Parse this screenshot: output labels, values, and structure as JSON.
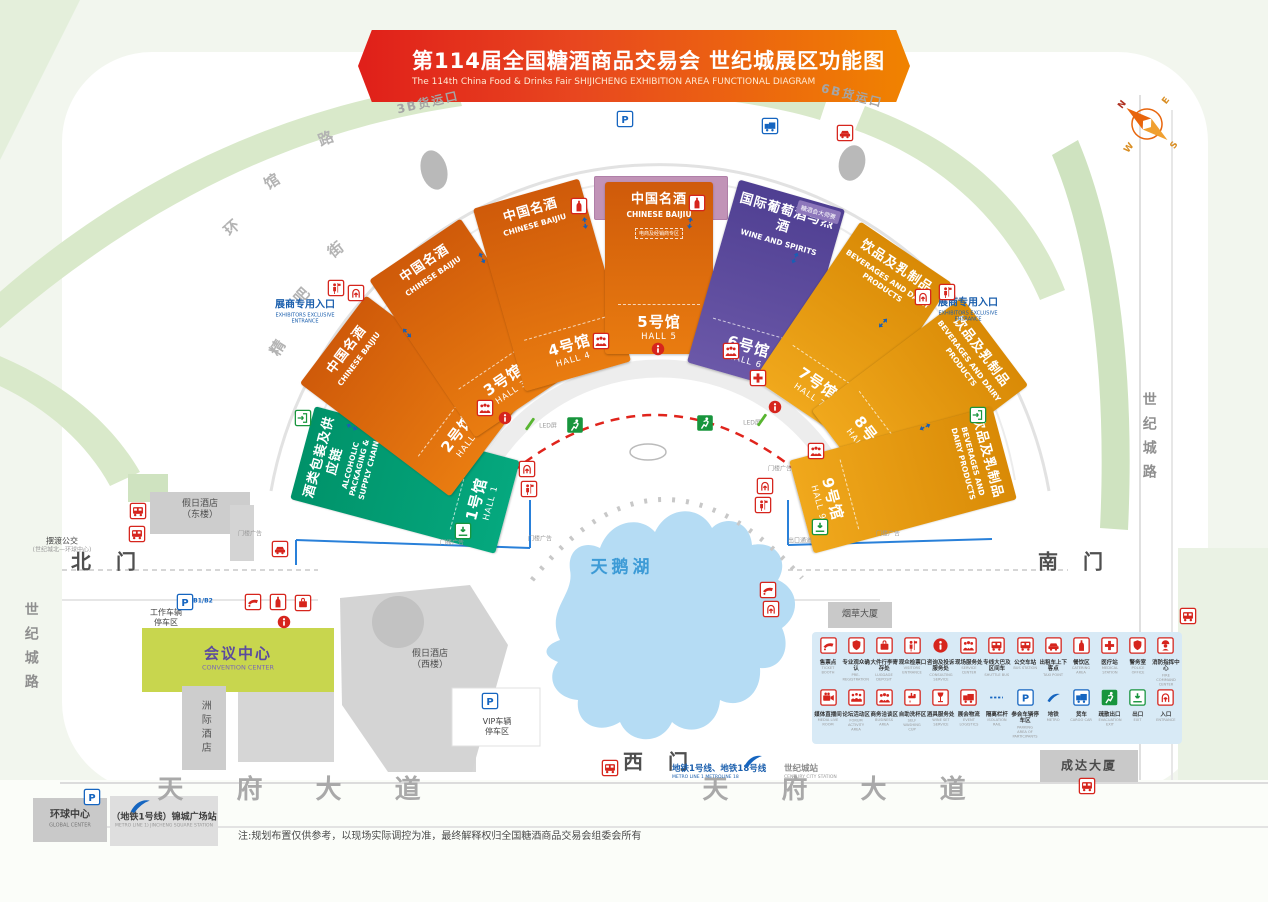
{
  "banner": {
    "title": "第114届全国糖酒商品交易会 世纪城展区功能图",
    "subtitle": "The 114th China Food & Drinks Fair SHIJICHENG EXHIBITION AREA FUNCTIONAL DIAGRAM"
  },
  "colors": {
    "orange": "#e06a0d",
    "gold": "#e8950c",
    "purple": "#5b4a9e",
    "green": "#00a376",
    "mauve": "#c193b7",
    "accent_red": "#d6251d",
    "accent_blue": "#1565c0",
    "accent_green": "#18953d",
    "lake_blue": "#b5dcf4"
  },
  "conference": {
    "zh": "会议活动区",
    "en": "CONFERENCE ACTIVITIES AREA"
  },
  "halls": [
    {
      "id": 1,
      "zh": "酒类包装及供应链",
      "en": "ALCOHOLIC PACKAGING & SUPPLY CHAIN",
      "num_zh": "1号馆",
      "num_en": "HALL 1",
      "palette": "green",
      "cx": 405,
      "cy": 480,
      "w": 96,
      "h": 212,
      "rot": -75
    },
    {
      "id": 2,
      "zh": "中国名酒",
      "en": "CHINESE BAIJIU",
      "num_zh": "2号馆",
      "num_en": "HALL 2",
      "palette": "orange",
      "cx": 408,
      "cy": 396,
      "w": 110,
      "h": 188,
      "rot": -53
    },
    {
      "id": 3,
      "zh": "中国名酒",
      "en": "CHINESE BAIJIU",
      "num_zh": "3号馆",
      "num_en": "HALL 3",
      "palette": "orange",
      "cx": 468,
      "cy": 328,
      "w": 110,
      "h": 190,
      "rot": -34
    },
    {
      "id": 4,
      "zh": "中国名酒",
      "en": "CHINESE BAIJIU",
      "num_zh": "4号馆",
      "num_en": "HALL 4",
      "palette": "orange",
      "cx": 552,
      "cy": 285,
      "w": 110,
      "h": 190,
      "rot": -16
    },
    {
      "id": 5,
      "zh": "中国名酒",
      "en": "CHINESE BAIJIU",
      "num_zh": "5号馆",
      "num_en": "HALL 5",
      "palette": "orange",
      "cx": 659,
      "cy": 268,
      "w": 108,
      "h": 172,
      "rot": 0,
      "note": "电商及经销商专区"
    },
    {
      "id": 6,
      "zh": "国际葡萄酒与烈酒",
      "en": "WINE AND SPIRITS",
      "num_zh": "6号馆",
      "num_en": "HALL 6",
      "palette": "purple",
      "cx": 766,
      "cy": 286,
      "w": 110,
      "h": 190,
      "rot": 16,
      "corner": "糖酒会大师赛"
    },
    {
      "id": 7,
      "zh": "饮品及乳制品",
      "en": "BEVERAGES AND DAIRY PRODUCTS",
      "num_zh": "7号馆",
      "num_en": "HALL 7",
      "palette": "gold",
      "cx": 853,
      "cy": 331,
      "w": 110,
      "h": 190,
      "rot": 34
    },
    {
      "id": 8,
      "zh": "饮品及乳制品",
      "en": "BEVERAGES AND DAIRY PRODUCTS",
      "num_zh": "8号馆",
      "num_en": "HALL 8",
      "palette": "gold",
      "cx": 920,
      "cy": 398,
      "w": 110,
      "h": 188,
      "rot": 53
    },
    {
      "id": 9,
      "zh": "饮品及乳制品",
      "en": "BEVERAGES AND DAIRY PRODUCTS",
      "num_zh": "9号馆",
      "num_en": "HALL 9",
      "palette": "gold",
      "cx": 903,
      "cy": 480,
      "w": 96,
      "h": 210,
      "rot": 75
    }
  ],
  "labels": [
    {
      "n": "north-gate",
      "x": 108,
      "y": 562,
      "l": [
        [
          "北 门",
          "g"
        ]
      ]
    },
    {
      "n": "south-gate",
      "x": 1075,
      "y": 562,
      "l": [
        [
          "南 门",
          "g"
        ]
      ]
    },
    {
      "n": "west-gate",
      "x": 660,
      "y": 762,
      "l": [
        [
          "西 门",
          "g"
        ]
      ]
    },
    {
      "n": "tianfu-avenue-left",
      "x": 300,
      "y": 790,
      "l": [
        [
          "天 府 大 道",
          "road-big"
        ]
      ]
    },
    {
      "n": "tianfu-avenue-right",
      "x": 845,
      "y": 790,
      "l": [
        [
          "天 府 大 道",
          "road-big"
        ]
      ]
    },
    {
      "n": "century-city-road-left",
      "x": 30,
      "y": 650,
      "l": [
        [
          "世纪城路",
          "vroad"
        ]
      ]
    },
    {
      "n": "century-city-road-right",
      "x": 1148,
      "y": 440,
      "l": [
        [
          "世纪城路",
          "vroad"
        ]
      ]
    },
    {
      "n": "ring-road-char-1",
      "x": 232,
      "y": 228,
      "r": -42,
      "l": [
        [
          "环",
          "curve"
        ]
      ]
    },
    {
      "n": "ring-road-char-2",
      "x": 272,
      "y": 182,
      "r": -32,
      "l": [
        [
          "馆",
          "curve"
        ]
      ]
    },
    {
      "n": "ring-road-char-3",
      "x": 326,
      "y": 139,
      "r": -22,
      "l": [
        [
          "路",
          "curve"
        ]
      ]
    },
    {
      "n": "street-char-1",
      "x": 278,
      "y": 348,
      "r": -58,
      "l": [
        [
          "精",
          "curve"
        ]
      ]
    },
    {
      "n": "street-char-2",
      "x": 302,
      "y": 296,
      "r": -48,
      "l": [
        [
          "吧",
          "curve"
        ]
      ]
    },
    {
      "n": "street-char-3",
      "x": 336,
      "y": 250,
      "r": -38,
      "l": [
        [
          "街",
          "curve"
        ]
      ]
    },
    {
      "n": "cargo-gate-3b",
      "x": 428,
      "y": 103,
      "r": -13,
      "l": [
        [
          "3B货运口",
          "curve-sm"
        ]
      ]
    },
    {
      "n": "cargo-gate-6b",
      "x": 852,
      "y": 96,
      "r": 14,
      "l": [
        [
          "6B货运口",
          "curve-sm"
        ]
      ]
    },
    {
      "n": "swan-lake",
      "x": 622,
      "y": 568,
      "l": [
        [
          "天鹅湖",
          "lake"
        ]
      ]
    },
    {
      "n": "exhibitor-entrance-left",
      "x": 305,
      "y": 312,
      "l": [
        [
          "展商专用入口",
          "b1"
        ],
        [
          "EXHIBITORS EXCLUSIVE",
          "b2"
        ],
        [
          "ENTRANCE",
          "b2"
        ]
      ]
    },
    {
      "n": "exhibitor-entrance-right",
      "x": 968,
      "y": 310,
      "l": [
        [
          "展商专用入口",
          "b1"
        ],
        [
          "EXHIBITORS EXCLUSIVE",
          "b2"
        ],
        [
          "ENTRANCE",
          "b2"
        ]
      ]
    },
    {
      "n": "holiday-inn-east",
      "x": 200,
      "y": 510,
      "l": [
        [
          "假日酒店",
          "bld"
        ],
        [
          "（东楼）",
          "bld"
        ]
      ]
    },
    {
      "n": "shuttle-bus-note",
      "x": 62,
      "y": 545,
      "l": [
        [
          "摆渡公交",
          "sm"
        ],
        [
          "(世纪城北—环球中心)",
          "tiny"
        ]
      ]
    },
    {
      "n": "staff-parking",
      "x": 166,
      "y": 618,
      "l": [
        [
          "工作车辆",
          "sm"
        ],
        [
          "停车区",
          "sm"
        ]
      ]
    },
    {
      "n": "staff-parking-levels",
      "x": 203,
      "y": 601,
      "l": [
        [
          "B1/B2",
          "pblue"
        ]
      ]
    },
    {
      "n": "convention-center",
      "x": 238,
      "y": 658,
      "l": [
        [
          "会议中心",
          "conv-zh"
        ],
        [
          "CONVENTION CENTER",
          "conv-en"
        ]
      ]
    },
    {
      "n": "intercontinental-hotel",
      "x": 204,
      "y": 728,
      "l": [
        [
          "洲际酒店",
          "vbld"
        ]
      ]
    },
    {
      "n": "holiday-inn-west",
      "x": 430,
      "y": 660,
      "l": [
        [
          "假日酒店",
          "bld"
        ],
        [
          "（西楼）",
          "bld"
        ]
      ]
    },
    {
      "n": "vip-parking",
      "x": 497,
      "y": 727,
      "l": [
        [
          "VIP车辆",
          "sm"
        ],
        [
          "停车区",
          "sm"
        ]
      ]
    },
    {
      "n": "west-metro-lines",
      "x": 672,
      "y": 772,
      "a": "l",
      "l": [
        [
          "地铁1号线、地铁18号线",
          "metro-b"
        ],
        [
          "METRO LINE 1  METROLINE 18",
          "metro-s"
        ]
      ]
    },
    {
      "n": "century-city-station",
      "x": 784,
      "y": 772,
      "a": "l",
      "l": [
        [
          "世纪城站",
          "sta-b"
        ],
        [
          "CENTURY CITY STATION",
          "sta-s"
        ]
      ]
    },
    {
      "n": "global-center",
      "x": 70,
      "y": 819,
      "l": [
        [
          "环球中心",
          "gc-zh"
        ],
        [
          "GLOBAL CENTER",
          "gc-en"
        ]
      ]
    },
    {
      "n": "jincheng-square-station",
      "x": 164,
      "y": 821,
      "l": [
        [
          "（地铁1号线）锦城广场站",
          "jc-zh"
        ],
        [
          "METRO LINE 1) JINCHENG SQUARE STATION",
          "jc-en"
        ]
      ]
    },
    {
      "n": "disclaimer-note",
      "x": 238,
      "y": 837,
      "a": "l",
      "l": [
        [
          "注:规划布置仅供参考，以现场实际调控为准，最终解释权归全国糖酒商品交易会组委会所有",
          "note"
        ]
      ]
    },
    {
      "n": "tobacco-building",
      "x": 860,
      "y": 615,
      "l": [
        [
          "烟草大厦",
          "bld"
        ]
      ]
    },
    {
      "n": "chengda-building",
      "x": 1089,
      "y": 766,
      "l": [
        [
          "成达大厦",
          "bld-lg"
        ]
      ]
    },
    {
      "n": "exit-passage",
      "x": 800,
      "y": 541,
      "l": [
        [
          "出口通道",
          "tiny"
        ]
      ]
    },
    {
      "n": "gate-ad-1",
      "x": 250,
      "y": 534,
      "l": [
        [
          "门楼广告",
          "tiny"
        ]
      ]
    },
    {
      "n": "gate-ad-2",
      "x": 452,
      "y": 543,
      "l": [
        [
          "门楼广告",
          "tiny"
        ]
      ]
    },
    {
      "n": "gate-ad-3",
      "x": 540,
      "y": 539,
      "l": [
        [
          "门楼广告",
          "tiny"
        ]
      ]
    },
    {
      "n": "gate-ad-4",
      "x": 780,
      "y": 469,
      "l": [
        [
          "门楼广告",
          "tiny"
        ]
      ]
    },
    {
      "n": "gate-ad-5",
      "x": 888,
      "y": 534,
      "l": [
        [
          "门楼广告",
          "tiny"
        ]
      ]
    },
    {
      "n": "led-screen-left",
      "x": 548,
      "y": 426,
      "l": [
        [
          "LED屏",
          "tiny"
        ]
      ]
    },
    {
      "n": "led-screen-right",
      "x": 752,
      "y": 423,
      "l": [
        [
          "LED屏",
          "tiny"
        ]
      ]
    }
  ],
  "map_icons": [
    {
      "t": "p",
      "x": 625,
      "y": 119,
      "n": "parking"
    },
    {
      "t": "truckB",
      "x": 770,
      "y": 126,
      "n": "cargo-truck"
    },
    {
      "t": "car",
      "x": 845,
      "y": 133,
      "n": "taxi"
    },
    {
      "t": "bus",
      "x": 138,
      "y": 511,
      "n": "shuttle-bus"
    },
    {
      "t": "bus",
      "x": 137,
      "y": 534,
      "n": "shuttle-bus"
    },
    {
      "t": "car",
      "x": 280,
      "y": 549,
      "n": "taxi"
    },
    {
      "t": "ticket",
      "x": 253,
      "y": 602,
      "n": "ticket-booth"
    },
    {
      "t": "bottle",
      "x": 278,
      "y": 602,
      "n": "pre-registration"
    },
    {
      "t": "luggage",
      "x": 303,
      "y": 603,
      "n": "luggage-deposit"
    },
    {
      "t": "info",
      "x": 284,
      "y": 622,
      "n": "information"
    },
    {
      "t": "p",
      "x": 185,
      "y": 602,
      "n": "staff-parking"
    },
    {
      "t": "p",
      "x": 490,
      "y": 701,
      "n": "vip-parking"
    },
    {
      "t": "p",
      "x": 92,
      "y": 797,
      "n": "parking"
    },
    {
      "t": "info",
      "x": 505,
      "y": 418,
      "n": "information"
    },
    {
      "t": "info",
      "x": 658,
      "y": 349,
      "n": "information"
    },
    {
      "t": "info",
      "x": 775,
      "y": 407,
      "n": "information"
    },
    {
      "t": "people",
      "x": 485,
      "y": 408,
      "n": "service-center"
    },
    {
      "t": "people",
      "x": 601,
      "y": 341,
      "n": "service-center"
    },
    {
      "t": "people",
      "x": 731,
      "y": 351,
      "n": "service-center"
    },
    {
      "t": "people",
      "x": 816,
      "y": 451,
      "n": "service-center"
    },
    {
      "t": "cross",
      "x": 758,
      "y": 378,
      "n": "medical-station"
    },
    {
      "t": "bottle",
      "x": 579,
      "y": 206,
      "n": "pre-registration"
    },
    {
      "t": "bottle",
      "x": 697,
      "y": 203,
      "n": "pre-registration"
    },
    {
      "t": "figure",
      "x": 336,
      "y": 288,
      "n": "exhibitor-check"
    },
    {
      "t": "doorIn",
      "x": 356,
      "y": 293,
      "n": "entrance"
    },
    {
      "t": "doorIn",
      "x": 923,
      "y": 297,
      "n": "entrance"
    },
    {
      "t": "figure",
      "x": 947,
      "y": 292,
      "n": "exhibitor-check"
    },
    {
      "t": "runner",
      "x": 575,
      "y": 425,
      "n": "evacuation-exit"
    },
    {
      "t": "runner",
      "x": 705,
      "y": 423,
      "n": "evacuation-exit"
    },
    {
      "t": "exitDown",
      "x": 463,
      "y": 531,
      "n": "exit"
    },
    {
      "t": "exitDown",
      "x": 820,
      "y": 527,
      "n": "exit"
    },
    {
      "t": "doorR",
      "x": 978,
      "y": 415,
      "n": "exit"
    },
    {
      "t": "doorR",
      "x": 303,
      "y": 418,
      "n": "exit"
    },
    {
      "t": "doorIn",
      "x": 527,
      "y": 469,
      "n": "entrance"
    },
    {
      "t": "figure",
      "x": 529,
      "y": 489,
      "n": "exhibitor-check"
    },
    {
      "t": "doorIn",
      "x": 765,
      "y": 486,
      "n": "entrance"
    },
    {
      "t": "figure",
      "x": 763,
      "y": 505,
      "n": "exhibitor-check"
    },
    {
      "t": "ticket",
      "x": 768,
      "y": 590,
      "n": "ticket-booth"
    },
    {
      "t": "doorIn",
      "x": 771,
      "y": 609,
      "n": "entrance"
    },
    {
      "t": "bus",
      "x": 610,
      "y": 768,
      "n": "bus-station"
    },
    {
      "t": "bus",
      "x": 1087,
      "y": 786,
      "n": "bus-station"
    },
    {
      "t": "bus",
      "x": 1188,
      "y": 616,
      "n": "bus-station"
    },
    {
      "t": "metro",
      "x": 753,
      "y": 761,
      "s": 24,
      "n": "metro"
    },
    {
      "t": "metro",
      "x": 140,
      "y": 806,
      "s": 26,
      "n": "metro"
    },
    {
      "t": "slashG",
      "x": 530,
      "y": 424,
      "n": "led-marker"
    },
    {
      "t": "slashG",
      "x": 762,
      "y": 420,
      "n": "led-marker"
    },
    {
      "t": "arrowB",
      "x": 352,
      "y": 427,
      "r": -64,
      "n": "two-way-arrow"
    },
    {
      "t": "arrowB",
      "x": 407,
      "y": 333,
      "r": -43,
      "n": "two-way-arrow"
    },
    {
      "t": "arrowB",
      "x": 482,
      "y": 258,
      "r": -25,
      "n": "two-way-arrow"
    },
    {
      "t": "arrowB",
      "x": 585,
      "y": 223,
      "r": -8,
      "n": "two-way-arrow"
    },
    {
      "t": "arrowB",
      "x": 690,
      "y": 223,
      "r": 8,
      "n": "two-way-arrow"
    },
    {
      "t": "arrowB",
      "x": 795,
      "y": 258,
      "r": 25,
      "n": "two-way-arrow"
    },
    {
      "t": "arrowB",
      "x": 883,
      "y": 323,
      "r": 43,
      "n": "two-way-arrow"
    },
    {
      "t": "arrowB",
      "x": 925,
      "y": 427,
      "r": 64,
      "n": "two-way-arrow"
    }
  ],
  "legend": {
    "rows": [
      [
        {
          "zh": "售票点",
          "en": "TICKET BOOTH",
          "icon": "ticket"
        },
        {
          "zh": "专业观众确认",
          "en": "PRE-REGISTRATION",
          "icon": "badge"
        },
        {
          "zh": "大件行李寄存处",
          "en": "LUGGAGE DEPOSIT",
          "icon": "luggage"
        },
        {
          "zh": "观众检票口",
          "en": "VISITORS ENTRANCE",
          "icon": "figure"
        },
        {
          "zh": "咨询及投诉服务处",
          "en": "CONSULTING SERVICE",
          "icon": "info"
        },
        {
          "zh": "现场服务处",
          "en": "SERVICE CENTER",
          "icon": "people"
        },
        {
          "zh": "专线大巴及区间车",
          "en": "SHUTTLE BUS",
          "icon": "bus"
        },
        {
          "zh": "公交车站",
          "en": "BUS STATION",
          "icon": "bus"
        },
        {
          "zh": "出租车上下客点",
          "en": "TAXI POINT",
          "icon": "car"
        },
        {
          "zh": "餐饮区",
          "en": "CATERING AREA",
          "icon": "bottle"
        },
        {
          "zh": "医疗站",
          "en": "MEDICAL STATION",
          "icon": "cross"
        },
        {
          "zh": "警务室",
          "en": "POLICE OFFICE",
          "icon": "badge"
        },
        {
          "zh": "消防指挥中心",
          "en": "FIRE COMMAND CENTER",
          "icon": "fire"
        }
      ],
      [
        {
          "zh": "媒体直播间",
          "en": "MEDIA LIVE ROOM",
          "icon": "camera"
        },
        {
          "zh": "论坛活动区",
          "en": "FORUM ACTIVITY AREA",
          "icon": "forum"
        },
        {
          "zh": "商务洽谈区",
          "en": "BUSINESS AREA",
          "icon": "people"
        },
        {
          "zh": "自助洗杯区",
          "en": "SELF WASHING CUP",
          "icon": "tap"
        },
        {
          "zh": "酒具服务处",
          "en": "WINE SET SERVICE",
          "icon": "wine"
        },
        {
          "zh": "展会物流",
          "en": "EVENT LOGISTICS",
          "icon": "truckR"
        },
        {
          "zh": "隔离栏杆",
          "en": "ISOLATION RAIL",
          "icon": "rail"
        },
        {
          "zh": "参会车辆停车区",
          "en": "PARKING AREA OF PARTICIPANTS",
          "icon": "p"
        },
        {
          "zh": "地铁",
          "en": "METRO",
          "icon": "metro"
        },
        {
          "zh": "货车",
          "en": "CARGO CAR",
          "icon": "truckB"
        },
        {
          "zh": "疏散出口",
          "en": "EVACUATION EXIT",
          "icon": "runner"
        },
        {
          "zh": "出口",
          "en": "EXIT",
          "icon": "exitDown"
        },
        {
          "zh": "入口",
          "en": "ENTRANCE",
          "icon": "doorIn"
        }
      ]
    ]
  },
  "compass": {
    "n": "N",
    "e": "E",
    "s": "S",
    "w": "W"
  }
}
